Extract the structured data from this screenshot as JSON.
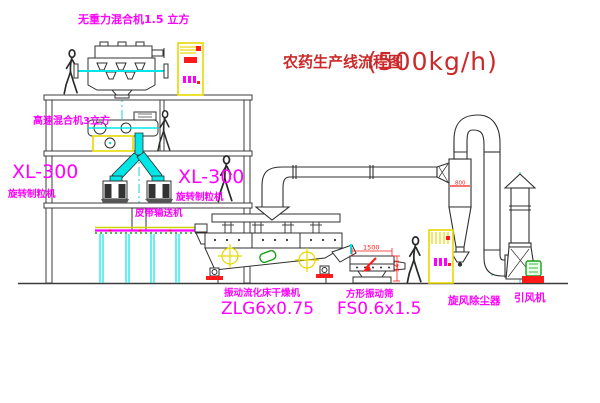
{
  "title": {
    "name": "农药生产线流程图",
    "capacity": "(500kg/h)"
  },
  "labels": {
    "gravity_mixer": "无重力混合机1.5 立方",
    "high_speed_mixer": "高速混合机3立方",
    "granulator_left": {
      "model": "XL-300",
      "name": "旋转制粒机"
    },
    "granulator_right": {
      "model": "XL-300",
      "name": "旋转制粒机"
    },
    "belt_conveyor": "皮带输送机",
    "dryer": {
      "name": "振动流化床干燥机",
      "model": "ZLG6x0.75"
    },
    "sieve": {
      "name": "方形振动筛",
      "model": "FS0.6x1.5"
    },
    "cyclone": "旋风除尘器",
    "fan": "引风机"
  },
  "dimensions": {
    "sieve_length": "1500",
    "sieve_height": "541",
    "cyclone_marking": "800"
  },
  "colors": {
    "label_magenta": "#ff00ff",
    "title_red": "#cc2a2a",
    "dim_red": "#ff1a1a",
    "pipe_cyan": "#00e5e5",
    "cabinet_yellow": "#ffff00",
    "detail_green": "#18a018",
    "line_dark": "#3c3c3c"
  }
}
